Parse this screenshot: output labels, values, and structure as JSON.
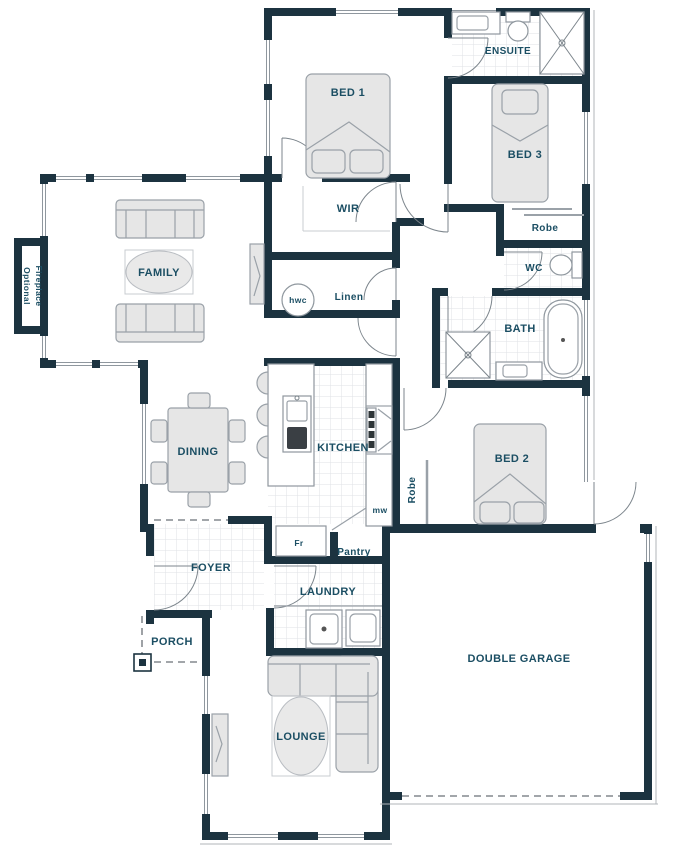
{
  "labels": {
    "bed1": "BED 1",
    "ensuite": "ENSUITE",
    "bed3": "BED 3",
    "wir": "WIR",
    "robe_bed3": "Robe",
    "wc": "WC",
    "optional": "Optional",
    "fireplace": "Fireplace",
    "family": "FAMILY",
    "hwc": "hwc",
    "linen": "Linen",
    "bath": "BATH",
    "dining": "DINING",
    "kitchen": "KITCHEN",
    "mw": "mw",
    "robe_bed2": "Robe",
    "bed2": "BED 2",
    "fr": "Fr",
    "pantry": "Pantry",
    "foyer": "FOYER",
    "laundry": "LAUNDRY",
    "porch": "PORCH",
    "lounge": "LOUNGE",
    "garage": "DOUBLE GARAGE"
  },
  "colors": {
    "wall": "#1c3340",
    "label": "#1b4e63",
    "furniture_fill": "#e6e6e6",
    "furniture_stroke": "#9aa1a8",
    "tile_line": "#d9dce0",
    "dash": "#6b7177"
  }
}
